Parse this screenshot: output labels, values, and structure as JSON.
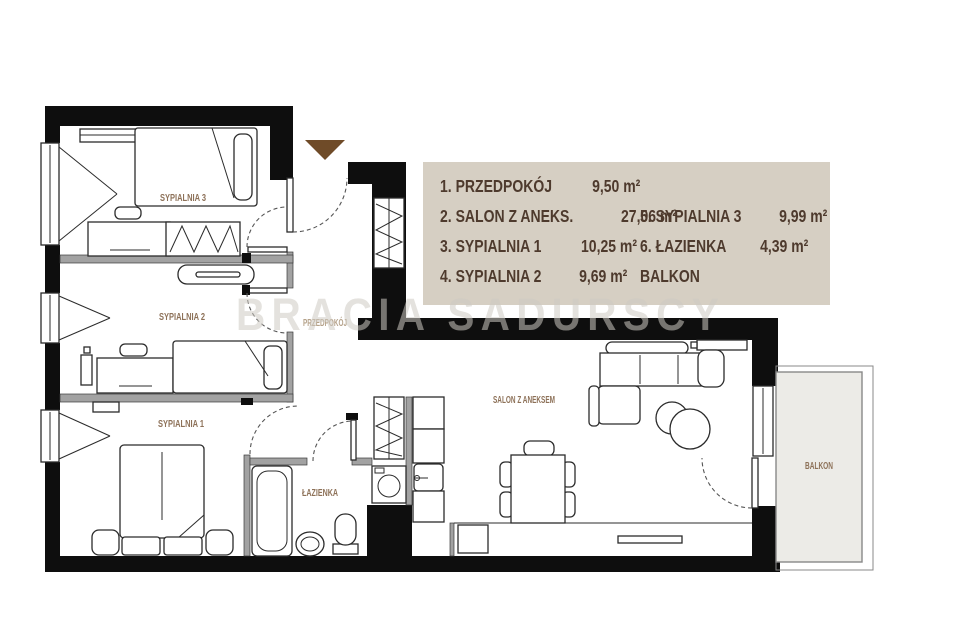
{
  "legend": {
    "col1": [
      {
        "label": "1. PRZEDPOKÓJ",
        "area": "9,50 m²"
      },
      {
        "label": "2. SALON Z ANEKS.",
        "area": "27,06 m²"
      },
      {
        "label": "3. SYPIALNIA 1",
        "area": "10,25 m²"
      },
      {
        "label": "4. SYPIALNIA 2",
        "area": "9,69 m²"
      }
    ],
    "col2": [
      {
        "label": "5. SYPIALNIA 3",
        "area": "9,99 m²"
      },
      {
        "label": "6. ŁAZIENKA",
        "area": "4,39 m²"
      },
      {
        "label": "BALKON",
        "area": ""
      }
    ]
  },
  "rooms": {
    "sypialnia3": "SYPIALNIA 3",
    "sypialnia2": "SYPIALNIA 2",
    "sypialnia1": "SYPIALNIA 1",
    "przedpokoj": "PRZEDPOKÓJ",
    "lazienka": "ŁAZIENKA",
    "salon": "SALON Z ANEKSEM",
    "balkon": "BALKON"
  },
  "watermark": "BRACIA SADURSCY",
  "colors": {
    "legend_bg": "#d6cfc3",
    "legend_text": "#4e3a2d",
    "room_label": "#8d7158",
    "hall_label": "#b5a28a",
    "wall": "#0e0e0e",
    "partition": "#a2a2a2",
    "entrance_arrow": "#6f4b28",
    "balcony_floor": "#ecebe7",
    "watermark_color": "#cecac2"
  }
}
